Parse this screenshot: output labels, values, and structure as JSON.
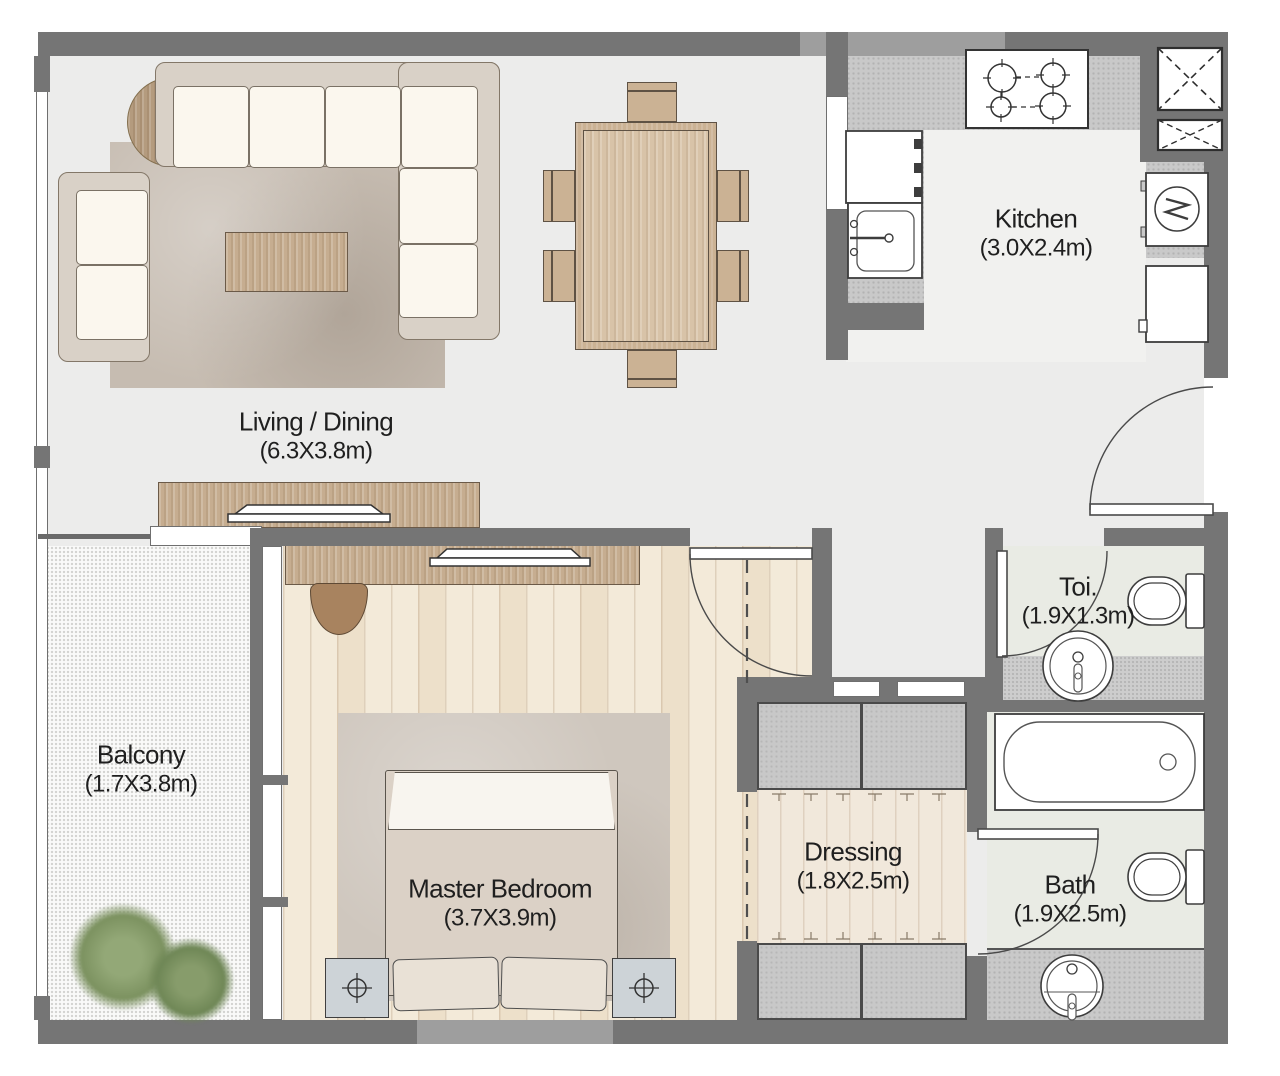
{
  "plan": {
    "rooms": {
      "living": {
        "name": "Living / Dining",
        "dims": "(6.3X3.8m)"
      },
      "kitchen": {
        "name": "Kitchen",
        "dims": "(3.0X2.4m)"
      },
      "balcony": {
        "name": "Balcony",
        "dims": "(1.7X3.8m)"
      },
      "master": {
        "name": "Master Bedroom",
        "dims": "(3.7X3.9m)"
      },
      "dressing": {
        "name": "Dressing",
        "dims": "(1.8X2.5m)"
      },
      "toilet": {
        "name": "Toi.",
        "dims": "(1.9X1.3m)"
      },
      "bath": {
        "name": "Bath",
        "dims": "(1.9X2.5m)"
      }
    },
    "fixtures": {
      "kitchen": [
        "stove-4-burner",
        "sink",
        "built-in-appliance",
        "washing-machine",
        "refrigerator",
        "service-shaft-large",
        "service-shaft-small"
      ],
      "toilet": [
        "wc",
        "pedestal-basin"
      ],
      "bath": [
        "bathtub",
        "wc",
        "vanity-basin"
      ],
      "master": [
        "double-bed",
        "pillows",
        "nightstand-left",
        "nightstand-right",
        "tv-console",
        "armchair",
        "rug"
      ],
      "living": [
        "corner-sofa",
        "loveseat",
        "coffee-table",
        "round-side-table",
        "rug",
        "dining-table-6-chairs",
        "tv-sideboard"
      ],
      "dressing": [
        "wardrobe-top",
        "wardrobe-bottom",
        "open-entry-dashed"
      ],
      "balcony": [
        "plants",
        "sliding-door"
      ]
    },
    "colors": {
      "wall": "#757575",
      "wall_light": "#9e9e9e",
      "floor": "#ececeb",
      "wood_floor": "#f3ead9",
      "furniture_wood": "#c6ad90",
      "counter": "#c9c9c9",
      "cushion": "#fbf7ee",
      "plant": "#7e935f",
      "bath_floor": "#e9ebe4",
      "text": "#1f1f1f"
    }
  }
}
